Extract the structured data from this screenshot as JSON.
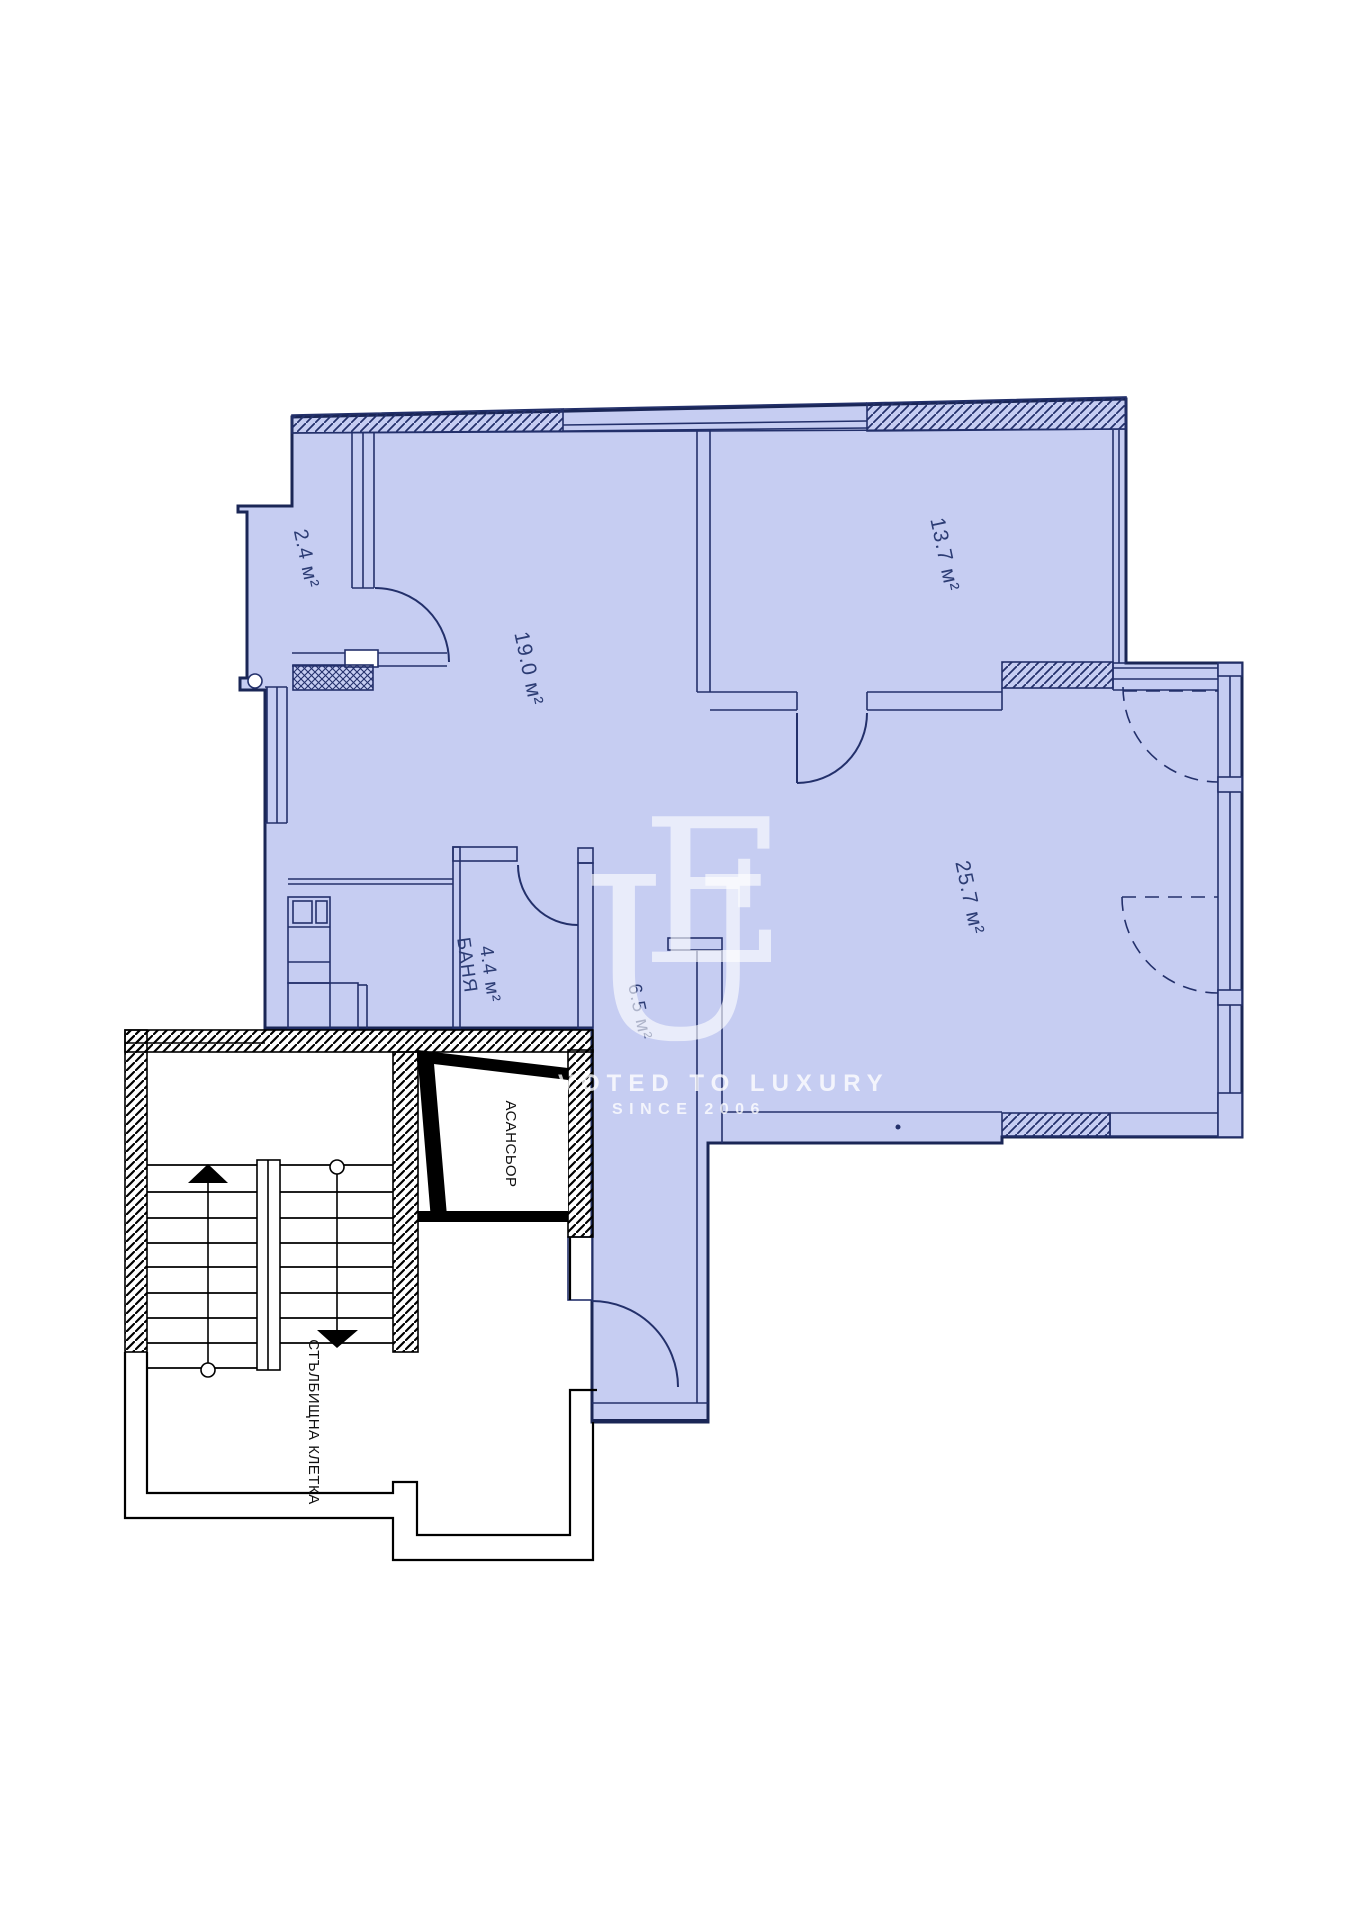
{
  "page": {
    "background": "#ffffff"
  },
  "colors": {
    "room_fill": "#c6cdf2",
    "wall_line": "#23306b",
    "outer_wall": "#1a2656",
    "stair_line": "#000000",
    "label": "#2c3c74",
    "watermark": "#ffffff"
  },
  "plan": {
    "rooms": [
      {
        "key": "closet",
        "area": "2.4 м²"
      },
      {
        "key": "living",
        "area": "19.0 м²"
      },
      {
        "key": "bedroom",
        "area": "13.7 м²"
      },
      {
        "key": "main_room",
        "area": "25.7 м²"
      },
      {
        "key": "bathroom",
        "name": "БАНЯ",
        "area": "4.4 м²"
      },
      {
        "key": "hallway",
        "area": "6.5 м²"
      }
    ],
    "elevator_label": "АСАНСЬОР",
    "stairwell_label": "СТЪЛБИЩНА КЛЕТКА"
  },
  "watermark": {
    "monogram_u": "U",
    "monogram_e": "E",
    "tagline": "VOTED TO LUXURY",
    "since": "SINCE 2006"
  }
}
